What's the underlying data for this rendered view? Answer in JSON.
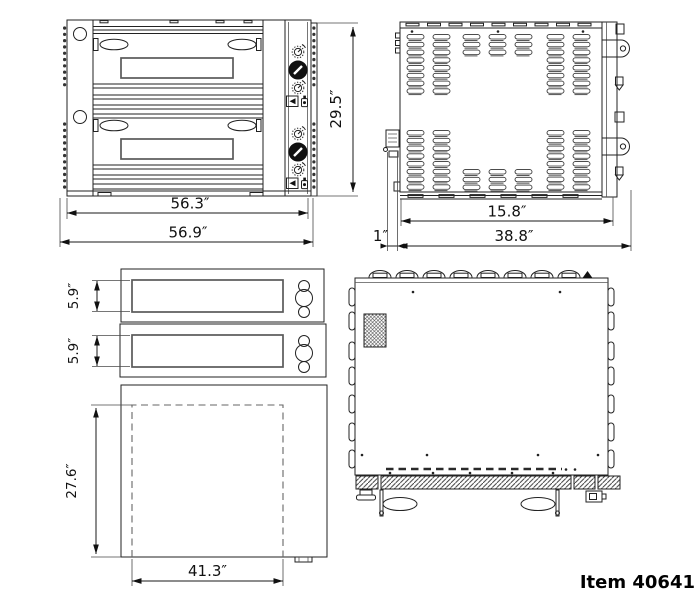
{
  "item_label": "Item 40641",
  "dimensions": {
    "front": {
      "inner_width": "56.3″",
      "overall_width": "56.9″",
      "overall_height": "29.5″"
    },
    "side": {
      "upper_depth": "15.8″",
      "front_offset": "1″",
      "overall_depth": "38.8″"
    },
    "openings": {
      "upper_height": "5.9″",
      "lower_height": "5.9″"
    },
    "chamber": {
      "depth": "27.6″",
      "width": "41.3″"
    }
  }
}
